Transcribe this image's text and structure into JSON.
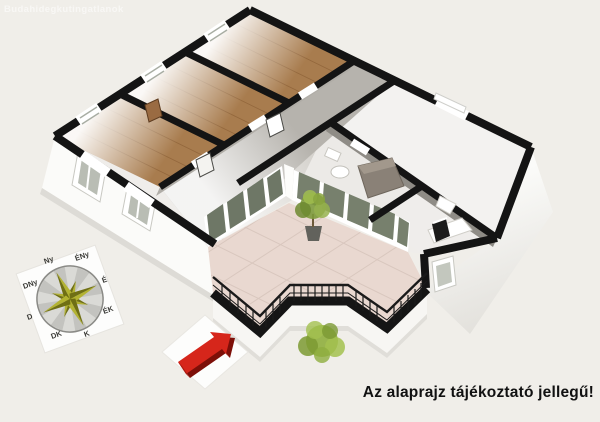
{
  "watermark": "Budahidegkutingatlanok",
  "disclaimer": "Az alaprajz tájékoztató jellegű!",
  "compass": {
    "labels": {
      "n": "É",
      "ne": "ÉK",
      "e": "K",
      "se": "DK",
      "s": "D",
      "sw": "DNy",
      "w": "Ny",
      "nw": "ÉNy"
    }
  },
  "colors": {
    "background": "#f0eee9",
    "wall_black": "#141414",
    "wood_floor": "#a87c4e",
    "hallway_floor": "#b6b3ad",
    "terrace_tile": "#e9d8d0",
    "glass_pane": "#6e7766",
    "plant_green": "#8aa83c",
    "compass_star_light": "#b3b332",
    "compass_star_dark": "#6f6f14",
    "arrow_red": "#d6261b",
    "arrow_red_dark": "#7d0f08",
    "text": "#111111"
  }
}
